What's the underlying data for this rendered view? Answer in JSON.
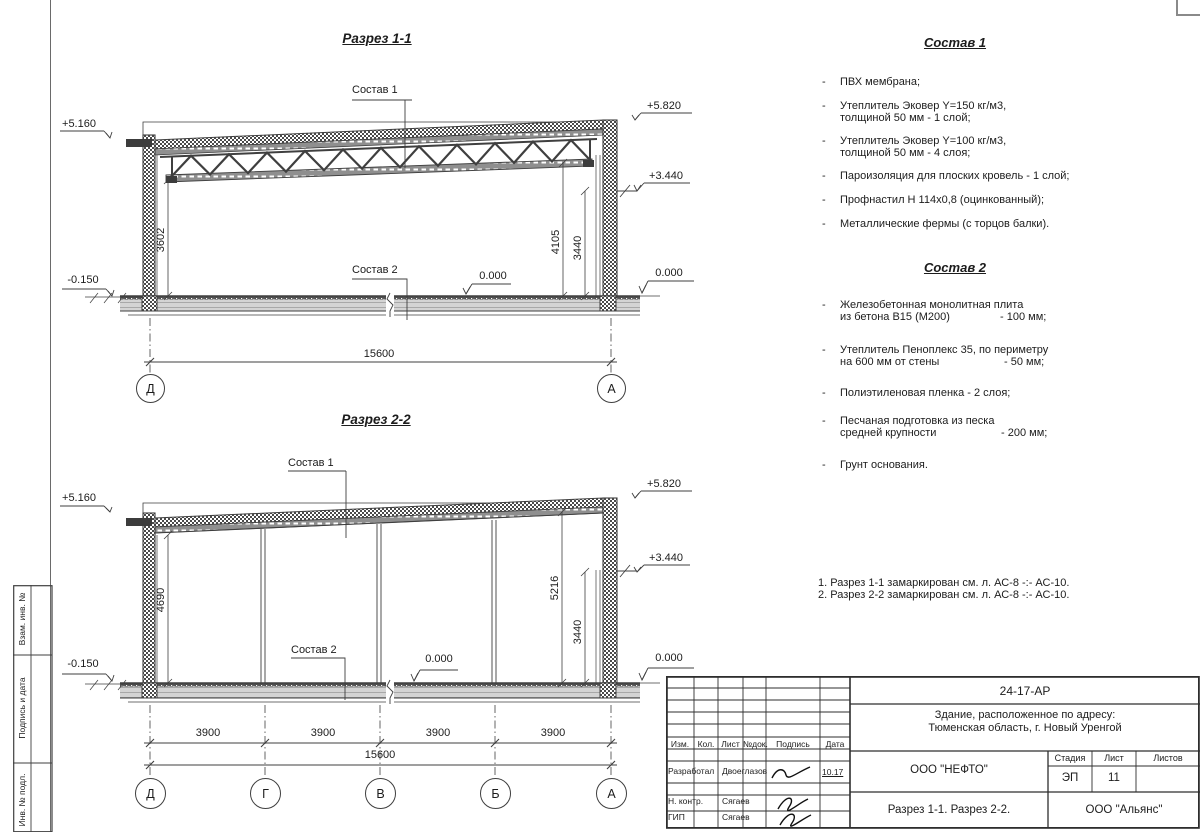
{
  "sidebar": {
    "cells": [
      "Взам. инв. №",
      "Подпись и дата",
      "Инв. № подл."
    ]
  },
  "s1": {
    "title": "Разрез 1-1",
    "sostav1": "Состав 1",
    "sostav2": "Состав 2",
    "elev": {
      "l_top": "+5.160",
      "r_top": "+5.820",
      "r_mid": "+3.440",
      "zero_mid": "0.000",
      "zero_right": "0.000",
      "l_low": "-0.150"
    },
    "dim": {
      "left": "3602",
      "right1": "4105",
      "right2": "3440",
      "span": "15600"
    },
    "axes": [
      "Д",
      "А"
    ]
  },
  "s2": {
    "title": "Разрез 2-2",
    "sostav1": "Состав 1",
    "sostav2": "Состав 2",
    "elev": {
      "l_top": "+5.160",
      "r_top": "+5.820",
      "r_mid": "+3.440",
      "zero_mid": "0.000",
      "zero_right": "0.000",
      "l_low": "-0.150"
    },
    "dim": {
      "left": "4690",
      "right1": "5216",
      "right2": "3440",
      "span": "15600",
      "bays": [
        "3900",
        "3900",
        "3900",
        "3900"
      ]
    },
    "axes": [
      "Д",
      "Г",
      "В",
      "Б",
      "А"
    ]
  },
  "list1": {
    "title": "Состав 1",
    "bullet": "-",
    "items": [
      {
        "l1": "ПВХ мембрана;"
      },
      {
        "l1": "Утеплитель Эковер Y=150 кг/м3,",
        "l2": "толщиной 50 мм - 1 слой;"
      },
      {
        "l1": "Утеплитель Эковер Y=100 кг/м3,",
        "l2": "толщиной 50 мм - 4 слоя;"
      },
      {
        "l1": "Пароизоляция для плоских кровель - 1 слой;"
      },
      {
        "l1": "Профнастил Н 114х0,8 (оцинкованный);"
      },
      {
        "l1": "Металлические фермы (с торцов балки)."
      }
    ]
  },
  "list2": {
    "title": "Состав 2",
    "bullet": "-",
    "items": [
      {
        "l1": "Железобетонная  монолитная плита",
        "l2": "из бетона В15 (М200)",
        "v": "- 100 мм;"
      },
      {
        "l1": "Утеплитель Пеноплекс 35, по периметру",
        "l2": "на 600 мм от стены",
        "v": "- 50 мм;"
      },
      {
        "l1": "Полиэтиленовая пленка - 2 слоя;"
      },
      {
        "l1": "Песчаная подготовка из песка",
        "l2": "средней крупности",
        "v": "- 200 мм;"
      },
      {
        "l1": "Грунт основания."
      }
    ]
  },
  "notes": {
    "n1": "1. Разрез 1-1 замаркирован см. л. АС-8 -:- АС-10.",
    "n2": "2. Разрез 2-2 замаркирован см. л. АС-8 -:- АС-10."
  },
  "tb": {
    "doc": "24-17-АР",
    "addr1": "Здание, расположенное по адресу:",
    "addr2": "Тюменская область, г. Новый Уренгой",
    "cols": {
      "izm": "Изм.",
      "kol": "Кол.",
      "list": "Лист",
      "ndoc": "№док.",
      "podpis": "Подпись",
      "data": "Дата"
    },
    "rows": {
      "r1": "Разработал",
      "r1n": "Двоеглазов",
      "r1d": "10.17",
      "r2": "Н. контр.",
      "r2n": "Сягаев",
      "r3": "ГИП",
      "r3n": "Сягаев"
    },
    "org": "ООО \"НЕФТО\"",
    "stage_h": "Стадия",
    "sheet_h": "Лист",
    "sheets_h": "Листов",
    "stage": "ЭП",
    "sheet": "11",
    "sheets": "",
    "caption": "Разрез 1-1. Разрез 2-2.",
    "org2": "ООО \"Альянс\""
  }
}
